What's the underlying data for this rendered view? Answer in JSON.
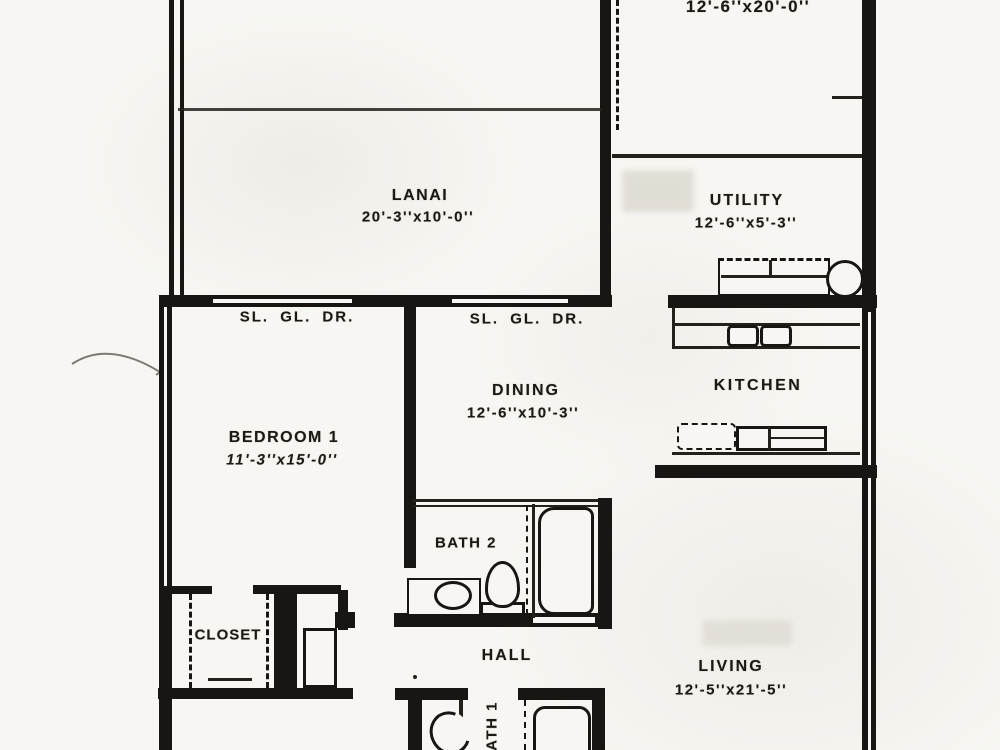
{
  "rooms": {
    "bedroom2": {
      "dims": "12'-6''x20'-0''"
    },
    "lanai": {
      "name": "LANAI",
      "dims": "20'-3''x10'-0''"
    },
    "utility": {
      "name": "UTILITY",
      "dims": "12'-6''x5'-3''"
    },
    "dining": {
      "name": "DINING",
      "dims": "12'-6''x10'-3''"
    },
    "kitchen": {
      "name": "KITCHEN"
    },
    "bedroom1": {
      "name": "BEDROOM 1",
      "dims": "11'-3''x15'-0''"
    },
    "bath2": {
      "name": "BATH 2"
    },
    "closet": {
      "name": "CLOSET"
    },
    "hall": {
      "name": "HALL"
    },
    "living": {
      "name": "LIVING",
      "dims": "12'-5''x21'-5''"
    },
    "bath1": {
      "name": "BATH 1"
    }
  },
  "doors": {
    "sliding_glass_door_1": "SL. GL. DR.",
    "sliding_glass_door_2": "SL. GL. DR."
  },
  "colors": {
    "ink": "#181512",
    "paper": "#f7f6f2"
  }
}
